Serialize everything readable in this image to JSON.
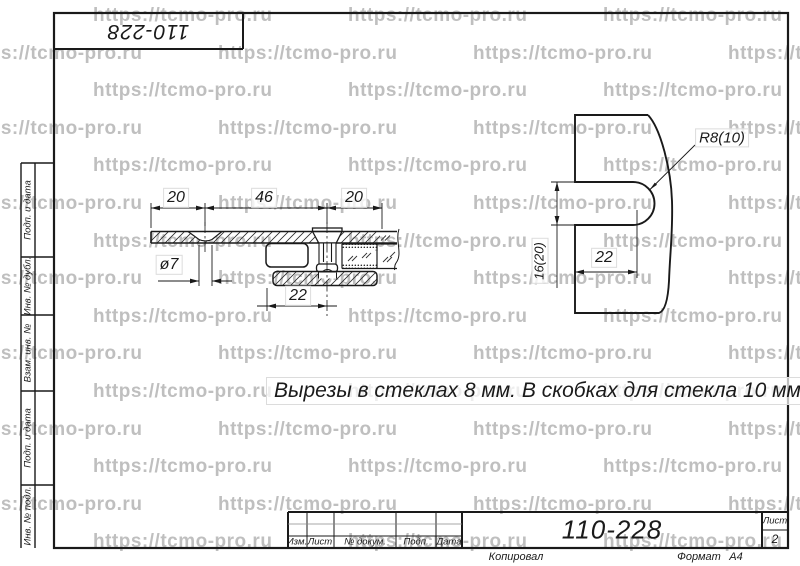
{
  "watermark": {
    "text": "https://tcmo-pro.ru"
  },
  "corner_stamp": {
    "doc_number": "110-228"
  },
  "side_strip": {
    "cells": [
      {
        "label": "Подп. и дата"
      },
      {
        "label": "Инв. № дубл."
      },
      {
        "label": "Взам. инв. №"
      },
      {
        "label": "Подп. и дата"
      },
      {
        "label": "Инв. № подл."
      }
    ]
  },
  "drawing": {
    "note": "Вырезы в стеклах 8 мм. В скобках для стекла 10 мм.",
    "section_view": {
      "dim_left": "20",
      "dim_middle": "46",
      "dim_right": "20",
      "hole_diameter": "ø7",
      "offset": "22"
    },
    "glass_view": {
      "radius": "R8(10)",
      "notch_height": "16(20)",
      "notch_depth": "22"
    }
  },
  "title_block": {
    "doc_number": "110-228",
    "columns": [
      "Изм.",
      "Лист",
      "№ докум.",
      "Подп.",
      "Дата"
    ],
    "sheet_label": "Лист",
    "sheet_number": "2",
    "copied_label": "Копировал",
    "format_label": "Формат",
    "format_value": "А4"
  }
}
